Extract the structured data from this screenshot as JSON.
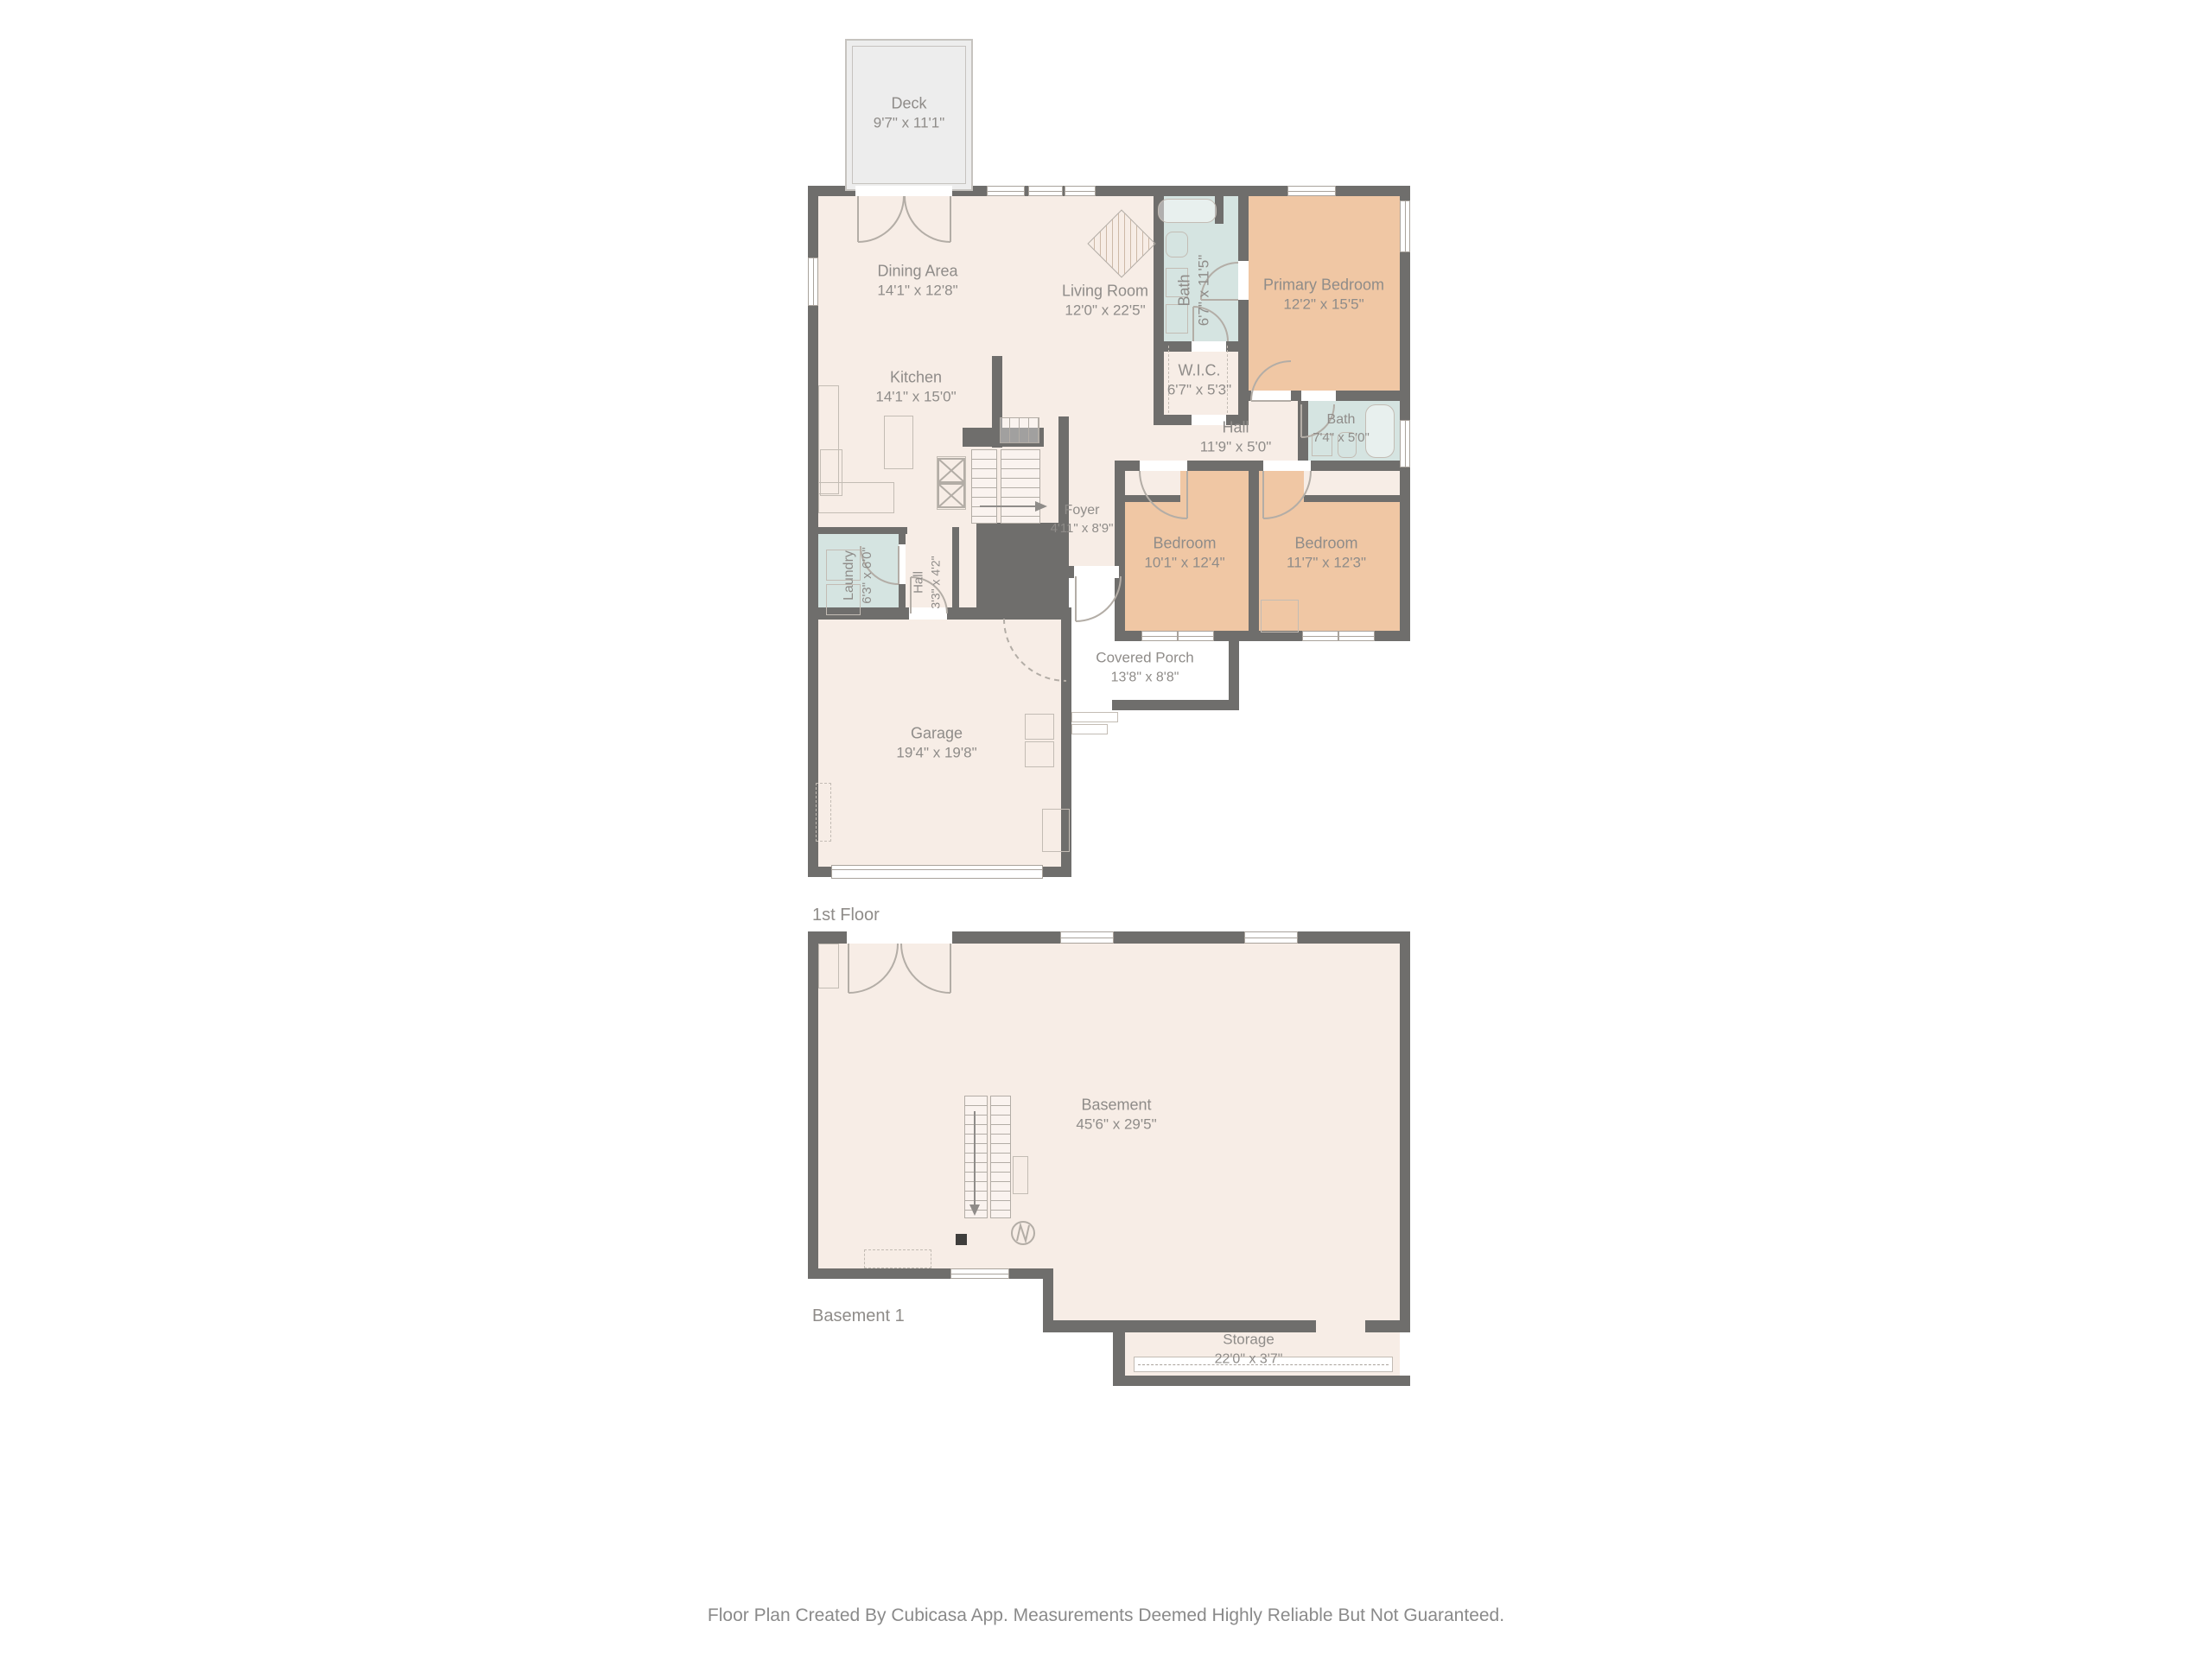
{
  "colors": {
    "wall": "#6f6e6c",
    "floor": "#f7ede6",
    "bedroom": "#f0c7a4",
    "bath": "#d5e4e1",
    "deck": "#ededed",
    "label": "#8f8c89"
  },
  "floor1": {
    "floor_label": "1st Floor",
    "rooms": {
      "deck": {
        "name": "Deck",
        "dims": "9'7\" x 11'1\""
      },
      "dining": {
        "name": "Dining Area",
        "dims": "14'1\" x 12'8\""
      },
      "living": {
        "name": "Living Room",
        "dims": "12'0\" x 22'5\""
      },
      "kitchen": {
        "name": "Kitchen",
        "dims": "14'1\" x 15'0\""
      },
      "bath_top": {
        "name": "Bath",
        "dims": "6'7\" x 11'5\""
      },
      "primary": {
        "name": "Primary Bedroom",
        "dims": "12'2\" x 15'5\""
      },
      "wic": {
        "name": "W.I.C.",
        "dims": "6'7\" x 5'3\""
      },
      "hall": {
        "name": "Hall",
        "dims": "11'9\" x 5'0\""
      },
      "bath_right": {
        "name": "Bath",
        "dims": "7'4\" x 5'0\""
      },
      "bedroom1": {
        "name": "Bedroom",
        "dims": "10'1\" x 12'4\""
      },
      "bedroom2": {
        "name": "Bedroom",
        "dims": "11'7\" x 12'3\""
      },
      "foyer": {
        "name": "Foyer",
        "dims": "4'11\" x 8'9\""
      },
      "laundry": {
        "name": "Laundry",
        "dims": "6'3\" x 6'0\""
      },
      "hall_small": {
        "name": "Hall",
        "dims": "3'3\" x 4'2\""
      },
      "garage": {
        "name": "Garage",
        "dims": "19'4\" x 19'8\""
      },
      "porch": {
        "name": "Covered Porch",
        "dims": "13'8\" x 8'8\""
      }
    }
  },
  "basement": {
    "floor_label": "Basement 1",
    "rooms": {
      "basement": {
        "name": "Basement",
        "dims": "45'6\" x 29'5\""
      },
      "storage": {
        "name": "Storage",
        "dims": "22'0\" x 3'7\""
      }
    }
  },
  "footer": {
    "text": "Floor Plan Created By Cubicasa App. Measurements Deemed Highly Reliable But Not Guaranteed."
  }
}
